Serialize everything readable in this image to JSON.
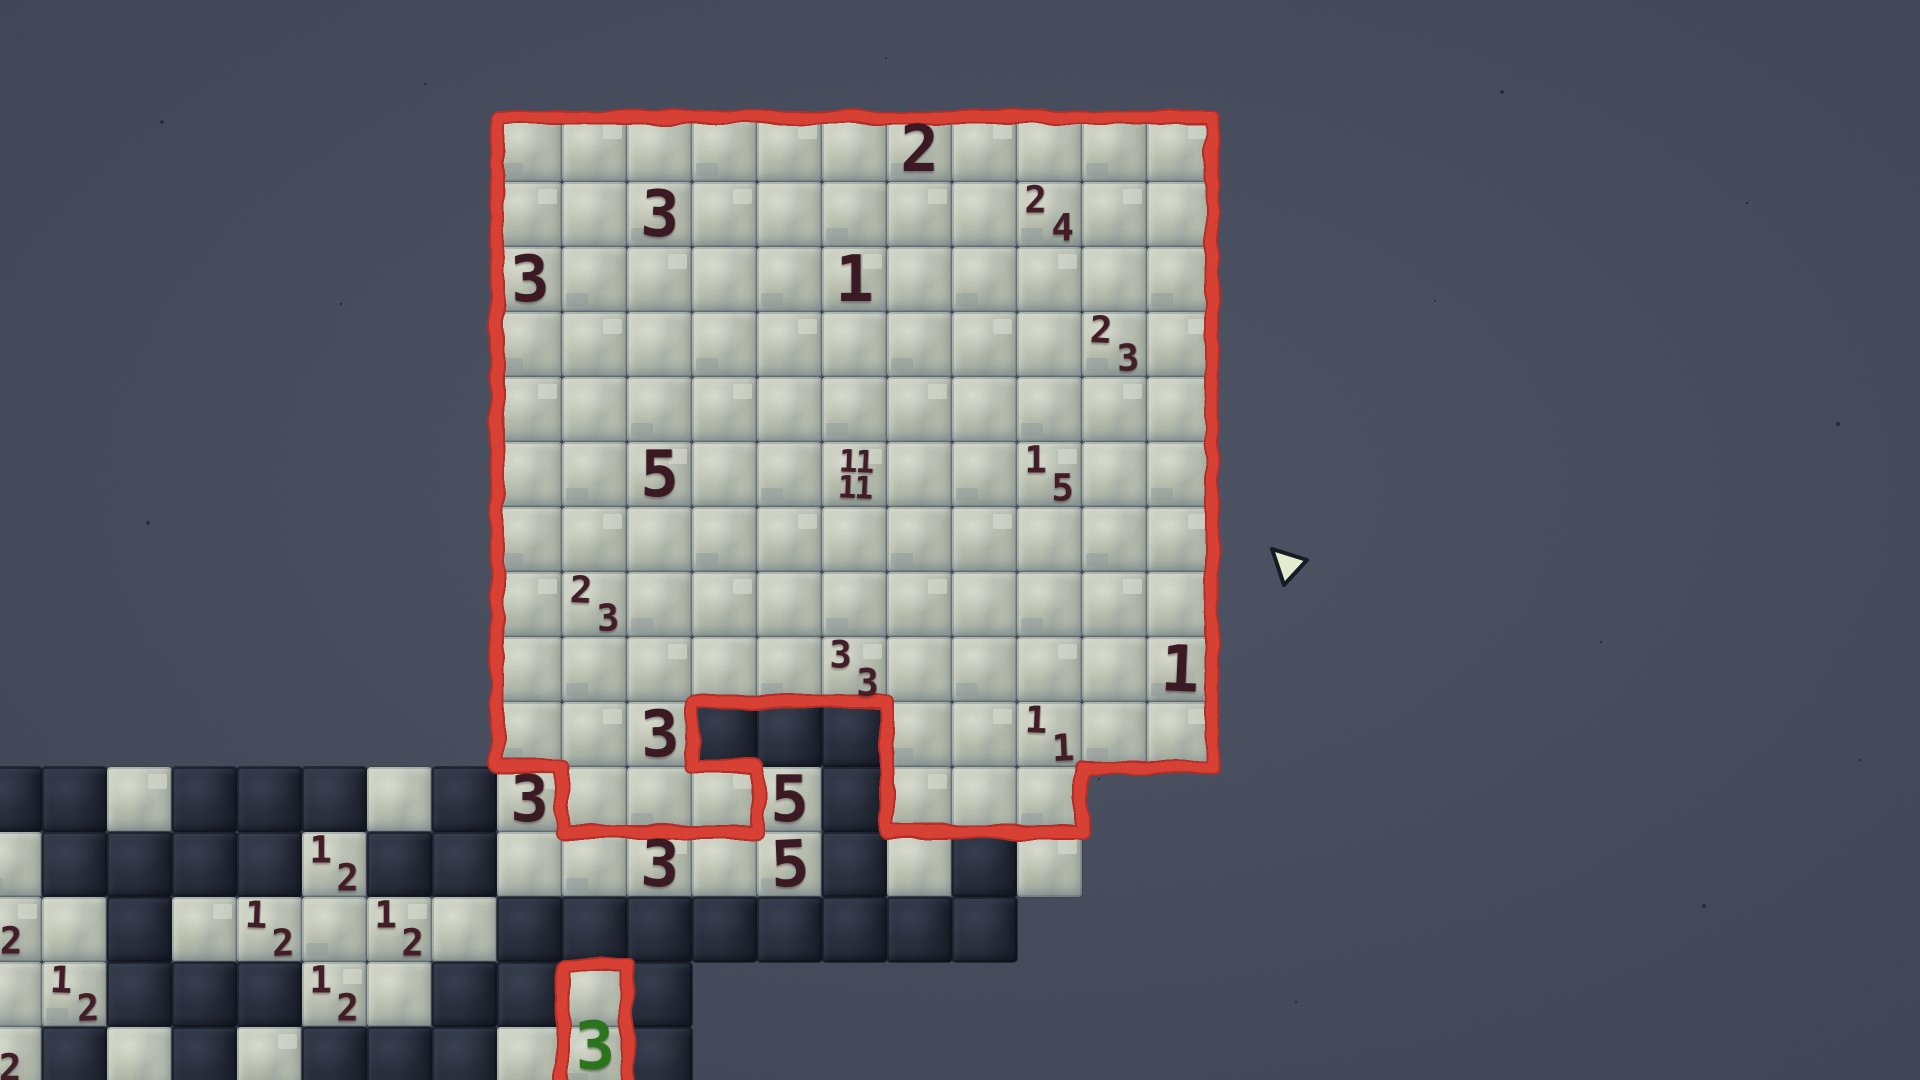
{
  "scene": {
    "width": 1920,
    "height": 1080,
    "game_type": "minesweeper-like tile puzzle"
  },
  "palette": {
    "background": "#4d5466",
    "tile_light": "#c3c9b7",
    "tile_dark": "#2b3140",
    "outline_red": "#e84539",
    "outline_red_deep": "#bf332b",
    "clue_big": "#3f1b26",
    "clue_small": "#471f2b",
    "clue_green": "#2e7d1d",
    "cursor_fill": "#e3ecce",
    "cursor_stroke": "#161b26"
  },
  "board": {
    "origin_x": 497,
    "origin_y": 117,
    "cell": 65,
    "region_rows": [
      {
        "row": 0,
        "cols": [
          0,
          1,
          2,
          3,
          4,
          5,
          6,
          7,
          8,
          9,
          10
        ]
      },
      {
        "row": 1,
        "cols": [
          0,
          1,
          2,
          3,
          4,
          5,
          6,
          7,
          8,
          9,
          10
        ]
      },
      {
        "row": 2,
        "cols": [
          0,
          1,
          2,
          3,
          4,
          5,
          6,
          7,
          8,
          9,
          10
        ]
      },
      {
        "row": 3,
        "cols": [
          0,
          1,
          2,
          3,
          4,
          5,
          6,
          7,
          8,
          9,
          10
        ]
      },
      {
        "row": 4,
        "cols": [
          0,
          1,
          2,
          3,
          4,
          5,
          6,
          7,
          8,
          9,
          10
        ]
      },
      {
        "row": 5,
        "cols": [
          0,
          1,
          2,
          3,
          4,
          5,
          6,
          7,
          8,
          9,
          10
        ]
      },
      {
        "row": 6,
        "cols": [
          0,
          1,
          2,
          3,
          4,
          5,
          6,
          7,
          8,
          9,
          10
        ]
      },
      {
        "row": 7,
        "cols": [
          0,
          1,
          2,
          3,
          4,
          5,
          6,
          7,
          8,
          9,
          10
        ]
      },
      {
        "row": 8,
        "cols": [
          0,
          1,
          2,
          3,
          4,
          5,
          6,
          7,
          8,
          9,
          10
        ]
      },
      {
        "row": 9,
        "cols": [
          0,
          1,
          2,
          6,
          7,
          8,
          9,
          10
        ]
      },
      {
        "row": 10,
        "cols": [
          1,
          2,
          3,
          6,
          7,
          8
        ]
      },
      {
        "row": 13,
        "cols": [
          1
        ]
      },
      {
        "row": 14,
        "cols": [
          1
        ]
      }
    ],
    "revealed_tiles": [
      {
        "col": 3,
        "row": 9,
        "type": "dark"
      },
      {
        "col": 4,
        "row": 9,
        "type": "dark"
      },
      {
        "col": 5,
        "row": 9,
        "type": "dark"
      },
      {
        "col": -8,
        "row": 10,
        "type": "dark"
      },
      {
        "col": -7,
        "row": 10,
        "type": "dark"
      },
      {
        "col": -6,
        "row": 10,
        "type": "light"
      },
      {
        "col": -5,
        "row": 10,
        "type": "dark"
      },
      {
        "col": -4,
        "row": 10,
        "type": "dark"
      },
      {
        "col": -3,
        "row": 10,
        "type": "dark"
      },
      {
        "col": -2,
        "row": 10,
        "type": "light"
      },
      {
        "col": -1,
        "row": 10,
        "type": "dark"
      },
      {
        "col": 0,
        "row": 10,
        "type": "light"
      },
      {
        "col": 4,
        "row": 10,
        "type": "light"
      },
      {
        "col": 5,
        "row": 10,
        "type": "dark"
      },
      {
        "col": -8,
        "row": 11,
        "type": "light"
      },
      {
        "col": -7,
        "row": 11,
        "type": "dark"
      },
      {
        "col": -6,
        "row": 11,
        "type": "dark"
      },
      {
        "col": -5,
        "row": 11,
        "type": "dark"
      },
      {
        "col": -4,
        "row": 11,
        "type": "dark"
      },
      {
        "col": -3,
        "row": 11,
        "type": "light"
      },
      {
        "col": -2,
        "row": 11,
        "type": "dark"
      },
      {
        "col": -1,
        "row": 11,
        "type": "dark"
      },
      {
        "col": 0,
        "row": 11,
        "type": "light"
      },
      {
        "col": 1,
        "row": 11,
        "type": "light"
      },
      {
        "col": 2,
        "row": 11,
        "type": "light"
      },
      {
        "col": 3,
        "row": 11,
        "type": "light"
      },
      {
        "col": 4,
        "row": 11,
        "type": "light"
      },
      {
        "col": 5,
        "row": 11,
        "type": "dark"
      },
      {
        "col": 6,
        "row": 11,
        "type": "light"
      },
      {
        "col": 7,
        "row": 11,
        "type": "dark"
      },
      {
        "col": 8,
        "row": 11,
        "type": "light"
      },
      {
        "col": -8,
        "row": 12,
        "type": "light"
      },
      {
        "col": -7,
        "row": 12,
        "type": "light"
      },
      {
        "col": -6,
        "row": 12,
        "type": "dark"
      },
      {
        "col": -5,
        "row": 12,
        "type": "light"
      },
      {
        "col": -4,
        "row": 12,
        "type": "light"
      },
      {
        "col": -3,
        "row": 12,
        "type": "light"
      },
      {
        "col": -2,
        "row": 12,
        "type": "light"
      },
      {
        "col": -1,
        "row": 12,
        "type": "light"
      },
      {
        "col": 0,
        "row": 12,
        "type": "dark"
      },
      {
        "col": 1,
        "row": 12,
        "type": "dark"
      },
      {
        "col": 2,
        "row": 12,
        "type": "dark"
      },
      {
        "col": 3,
        "row": 12,
        "type": "dark"
      },
      {
        "col": 4,
        "row": 12,
        "type": "dark"
      },
      {
        "col": 5,
        "row": 12,
        "type": "dark"
      },
      {
        "col": 6,
        "row": 12,
        "type": "dark"
      },
      {
        "col": 7,
        "row": 12,
        "type": "dark"
      },
      {
        "col": -8,
        "row": 13,
        "type": "light"
      },
      {
        "col": -7,
        "row": 13,
        "type": "light"
      },
      {
        "col": -6,
        "row": 13,
        "type": "dark"
      },
      {
        "col": -5,
        "row": 13,
        "type": "dark"
      },
      {
        "col": -4,
        "row": 13,
        "type": "dark"
      },
      {
        "col": -3,
        "row": 13,
        "type": "light"
      },
      {
        "col": -2,
        "row": 13,
        "type": "light"
      },
      {
        "col": -1,
        "row": 13,
        "type": "dark"
      },
      {
        "col": 0,
        "row": 13,
        "type": "dark"
      },
      {
        "col": 2,
        "row": 13,
        "type": "dark"
      },
      {
        "col": -8,
        "row": 14,
        "type": "light"
      },
      {
        "col": -7,
        "row": 14,
        "type": "dark"
      },
      {
        "col": -6,
        "row": 14,
        "type": "light"
      },
      {
        "col": -5,
        "row": 14,
        "type": "dark"
      },
      {
        "col": -4,
        "row": 14,
        "type": "light"
      },
      {
        "col": -3,
        "row": 14,
        "type": "dark"
      },
      {
        "col": -2,
        "row": 14,
        "type": "dark"
      },
      {
        "col": -1,
        "row": 14,
        "type": "dark"
      },
      {
        "col": 0,
        "row": 14,
        "type": "light"
      },
      {
        "col": 2,
        "row": 14,
        "type": "dark"
      }
    ],
    "outline_main_path": "M 497 117 L 1212 117 L 1212 767 L 1082 767 L 1082 832 L 887 832 L 887 702 L 692 702 L 692 767 L 757 767 L 757 832 L 562 832 L 562 767 L 497 767 Z",
    "outline_small_path": "M 562 1088 L 562 964 L 627 964 L 627 1088"
  },
  "clues": {
    "big": [
      {
        "col": 6,
        "row": 0,
        "value": "2"
      },
      {
        "col": 2,
        "row": 1,
        "value": "3"
      },
      {
        "col": 0,
        "row": 2,
        "value": "3"
      },
      {
        "col": 5,
        "row": 2,
        "value": "1"
      },
      {
        "col": 2,
        "row": 5,
        "value": "5"
      },
      {
        "col": 10,
        "row": 8,
        "value": "1"
      },
      {
        "col": 2,
        "row": 9,
        "value": "3"
      },
      {
        "col": 0,
        "row": 10,
        "value": "3"
      },
      {
        "col": 4,
        "row": 10,
        "value": "5"
      },
      {
        "col": 2,
        "row": 11,
        "value": "3"
      },
      {
        "col": 4,
        "row": 11,
        "value": "5"
      }
    ],
    "pairs": [
      {
        "col": 8,
        "row": 1,
        "top": "2",
        "bottom": "4"
      },
      {
        "col": 9,
        "row": 3,
        "top": "2",
        "bottom": "3"
      },
      {
        "col": 8,
        "row": 5,
        "top": "1",
        "bottom": "5"
      },
      {
        "col": 1,
        "row": 7,
        "top": "2",
        "bottom": "3"
      },
      {
        "col": 5,
        "row": 8,
        "top": "3",
        "bottom": "3"
      },
      {
        "col": 8,
        "row": 9,
        "top": "1",
        "bottom": "1"
      },
      {
        "col": -3,
        "row": 11,
        "top": "1",
        "bottom": "2"
      },
      {
        "col": -4,
        "row": 12,
        "top": "1",
        "bottom": "2"
      },
      {
        "col": -2,
        "row": 12,
        "top": "1",
        "bottom": "2"
      },
      {
        "col": -7,
        "row": 13,
        "top": "1",
        "bottom": "2"
      },
      {
        "col": -3,
        "row": 13,
        "top": "1",
        "bottom": "2"
      }
    ],
    "stacked": [
      {
        "col": 5,
        "row": 5,
        "top": "11",
        "bottom": "11"
      }
    ],
    "green": [
      {
        "col": 1,
        "row": 14,
        "value": "3",
        "dx": 0,
        "dy": -14
      }
    ],
    "edge_partials": [
      {
        "x": 11,
        "y": 941,
        "value": "2"
      },
      {
        "x": 10,
        "y": 1068,
        "value": "2"
      }
    ]
  },
  "cursor": {
    "points": "1272,549 1307,560 1284,585"
  }
}
